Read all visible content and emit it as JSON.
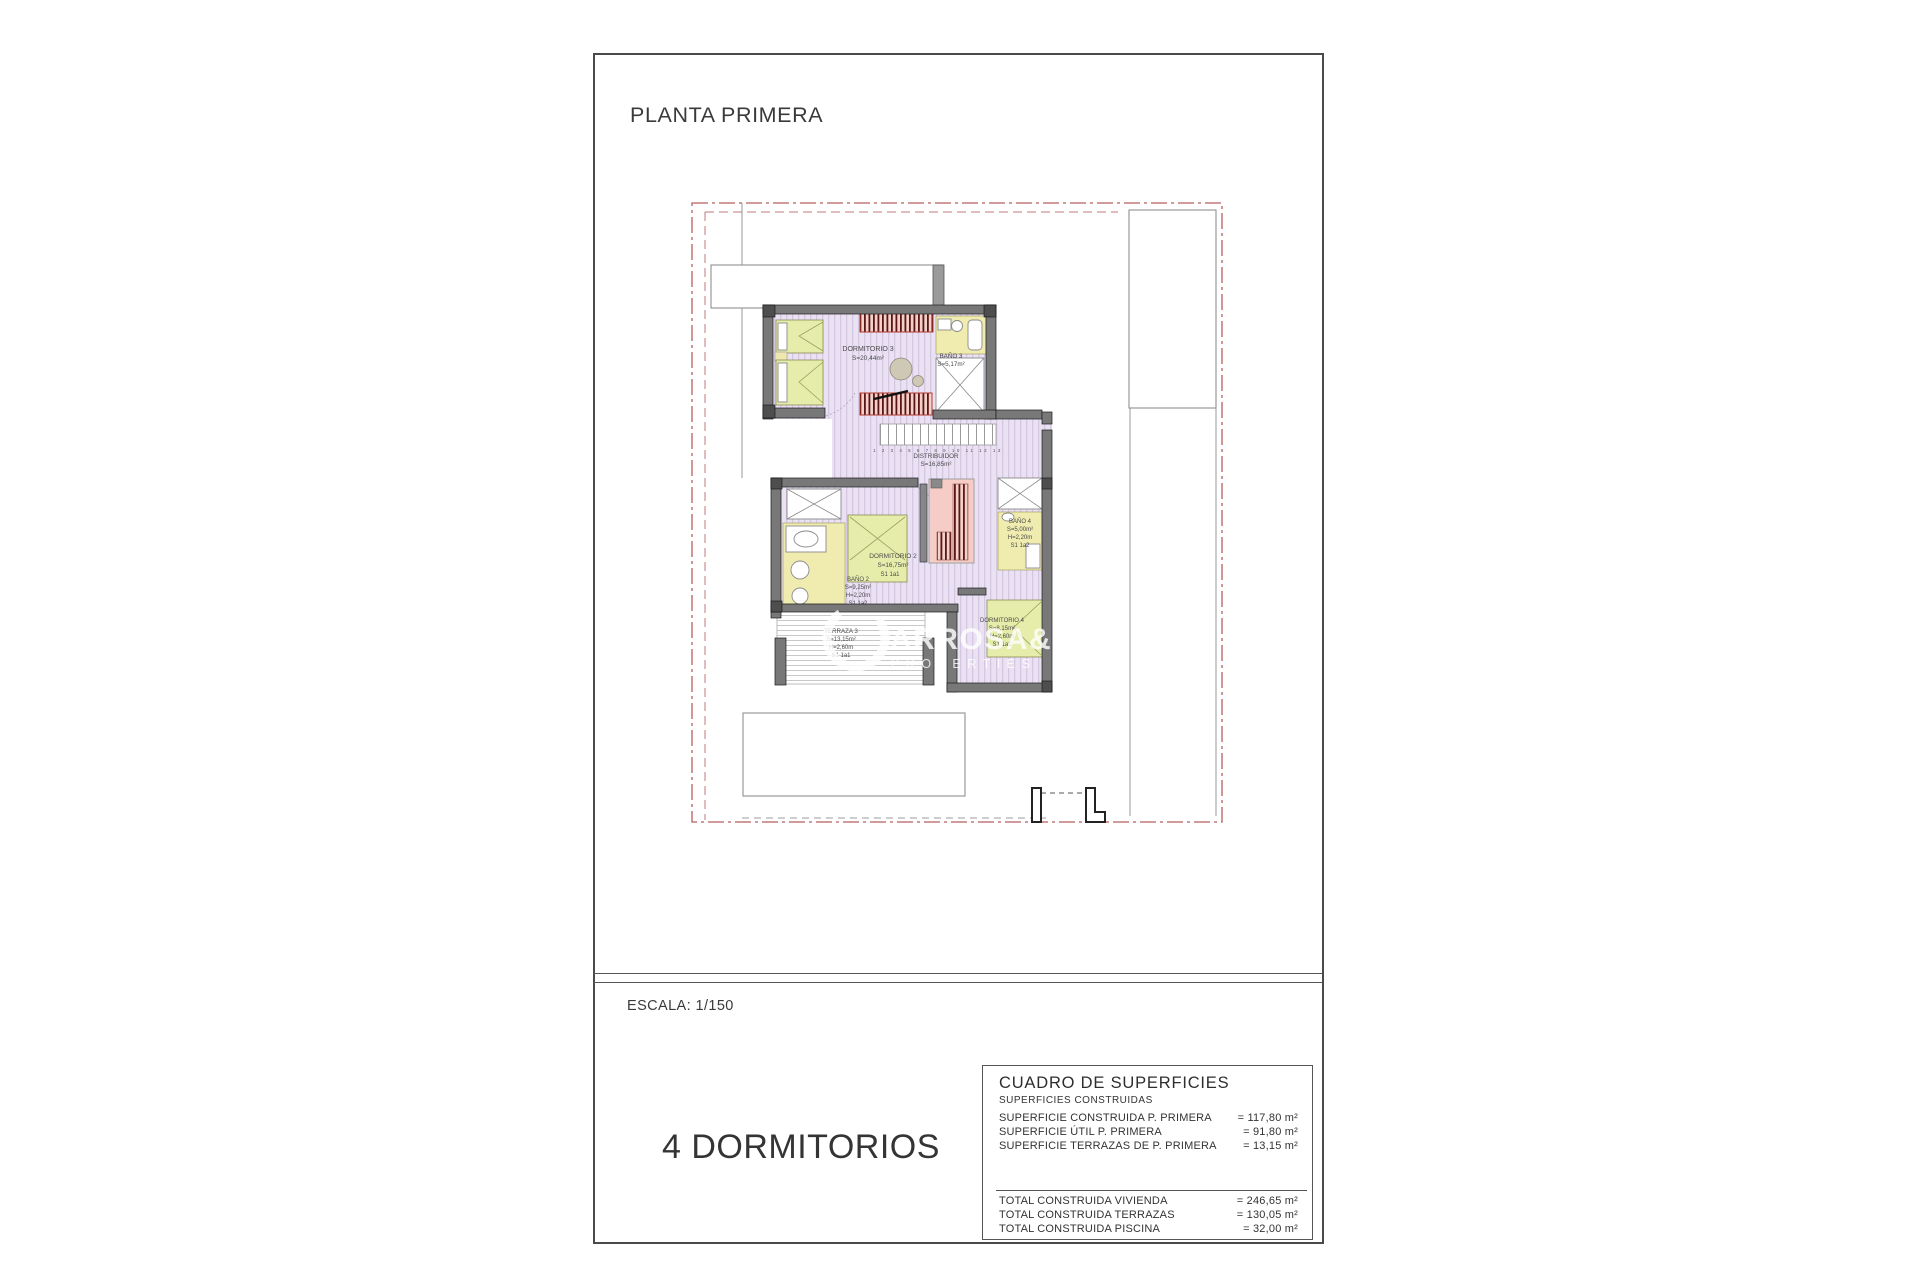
{
  "sheet": {
    "title": "PLANTA PRIMERA",
    "scale_label": "ESCALA: 1/150",
    "bedrooms_label": "4 DORMITORIOS"
  },
  "summary_table": {
    "title": "CUADRO DE SUPERFICIES",
    "subtitle": "SUPERFICIES CONSTRUIDAS",
    "rows": [
      {
        "label": "SUPERFICIE CONSTRUIDA P. PRIMERA",
        "value": "= 117,80 m²"
      },
      {
        "label": "SUPERFICIE ÚTIL P. PRIMERA",
        "value": "= 91,80 m²"
      },
      {
        "label": "SUPERFICIE TERRAZAS DE P. PRIMERA",
        "value": "= 13,15 m²"
      }
    ],
    "totals": [
      {
        "label": "TOTAL CONSTRUIDA VIVIENDA",
        "value": "= 246,65 m²"
      },
      {
        "label": "TOTAL CONSTRUIDA TERRAZAS",
        "value": "= 130,05 m²"
      },
      {
        "label": "TOTAL CONSTRUIDA PISCINA",
        "value": "= 32,00 m²"
      }
    ]
  },
  "rooms": {
    "dormitorio3": {
      "name": "DORMITORIO 3",
      "area": "S=20,44m²"
    },
    "bano3": {
      "name": "BAÑO 3",
      "area": "S=5,17m²"
    },
    "distribuidor": {
      "name": "DISTRIBUIDOR",
      "area": "S=16,85m²"
    },
    "dormitorio2": {
      "name": "DORMITORIO 2",
      "area": "S=16,75m²",
      "note": "S1 1a1"
    },
    "bano2": {
      "name": "BAÑO 2",
      "area": "S=9,25m²",
      "height": "H=2,20m",
      "note": "S1 1a2"
    },
    "terraza3": {
      "name": "TERRAZA 3",
      "area": "S=13,15m²",
      "height": "H=2,60m",
      "note": "S1 1a1"
    },
    "dormitorio4": {
      "name": "DORMITORIO 4",
      "area": "S=8,15m²",
      "height": "H=2,60m",
      "note": "S1 1a1"
    },
    "bano4": {
      "name": "BAÑO 4",
      "area": "S=5,00m²",
      "height": "H=2,20m",
      "note": "S1 1a2"
    }
  },
  "stairs": {
    "numbers": "1 2 3 4 5 6 7 8 9 10 11 12 13"
  },
  "watermark": {
    "line1": "ARROSA&B",
    "line2": "PROPERTIES"
  },
  "colors": {
    "floor_lilac": "#eae2f3",
    "floor_stripe": "#d3c7e2",
    "bath_yellow": "#f0ecb0",
    "bed_green": "#e6edaa",
    "wall_gray": "#787878",
    "wardrobe_pink": "#f3d0ca",
    "wardrobe_bar": "#5a1616",
    "closet_pink": "#f6cdc6",
    "boundary_red": "#b85f5f",
    "watermark_white": "#ffffff"
  }
}
